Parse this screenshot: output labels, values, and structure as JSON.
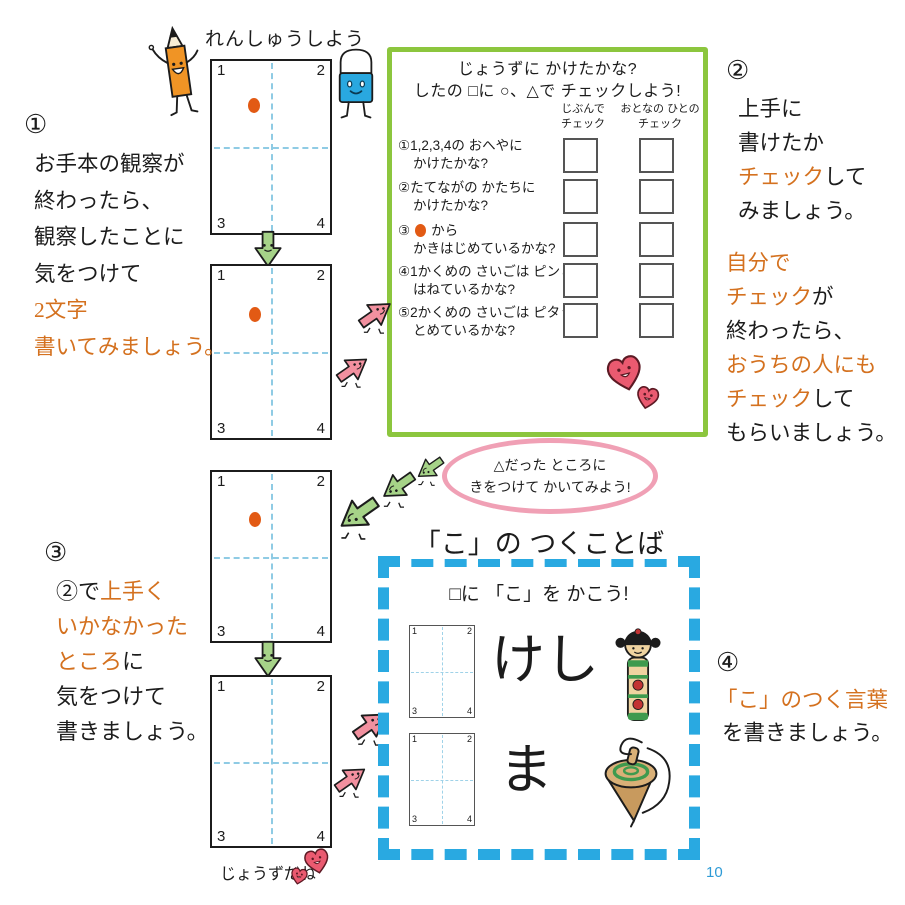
{
  "page": {
    "title": "れんしゅうしよう",
    "page_number": "10",
    "praise_note": "じょうずだね"
  },
  "colors": {
    "accent_orange": "#D4711F",
    "panel_green": "#8CC63E",
    "dash_blue": "#29A9E1",
    "bubble_pink": "#F0A0B5",
    "guide_line_blue": "#8FCBE4",
    "start_dot_orange": "#E25A14",
    "page_number_blue": "#2E9BD6"
  },
  "practice_box": {
    "corners": [
      "1",
      "2",
      "3",
      "4"
    ]
  },
  "steps": {
    "step1": {
      "num": "①",
      "l1": "お手本の観察が",
      "l2": "終わったら、",
      "l3": "観察したことに",
      "l4": "気をつけて",
      "l5": "2文字",
      "l6": "書いてみましょう。"
    },
    "step2": {
      "num": "②",
      "l1": "上手に",
      "l2": "書けたか",
      "l3a": "チェック",
      "l3b": "して",
      "l4": "みましょう。",
      "l5": "自分で",
      "l6a": "チェック",
      "l6b": "が",
      "l7": "終わったら、",
      "l8": "おうちの人にも",
      "l9a": "チェック",
      "l9b": "して",
      "l10": "もらいましょう。"
    },
    "step3": {
      "num": "③",
      "l1a": "②で",
      "l1b": "上手く",
      "l2": "いかなかった",
      "l3a": "ところ",
      "l3b": "に",
      "l4": "気をつけて",
      "l5": "書きましょう。"
    },
    "step4": {
      "num": "④",
      "l1": "「こ」のつく言葉",
      "l2": "を書きましょう。"
    }
  },
  "check_panel": {
    "title_line1": "じょうずに かけたかな?",
    "title_line2": "したの □に ○、△で チェックしよう!",
    "col_self_line1": "じぶんで",
    "col_self_line2": "チェック",
    "col_adult_line1": "おとなの ひとの",
    "col_adult_line2": "チェック",
    "items": [
      {
        "num": "①",
        "l1": "1,2,3,4の おへやに",
        "l2": "かけたかな?"
      },
      {
        "num": "②",
        "l1": "たてながの かたちに",
        "l2": "かけたかな?"
      },
      {
        "num": "③",
        "l1": "から",
        "l2": "かきはじめているかな?"
      },
      {
        "num": "④",
        "l1": "1かくめの さいごは ピンと",
        "l2": "はねているかな?"
      },
      {
        "num": "⑤",
        "l1": "2かくめの さいごは ピタッと",
        "l2": "とめているかな?"
      }
    ]
  },
  "hint_bubble": {
    "line1": "△だった ところに",
    "line2": "きをつけて かいてみよう!"
  },
  "word_section": {
    "title": "「こ」の つくことば",
    "subtitle": "□に 「こ」を かこう!",
    "items": [
      {
        "word": "けし",
        "icon": "kokeshi-doll"
      },
      {
        "word": "ま",
        "icon": "spinning-top"
      }
    ]
  }
}
